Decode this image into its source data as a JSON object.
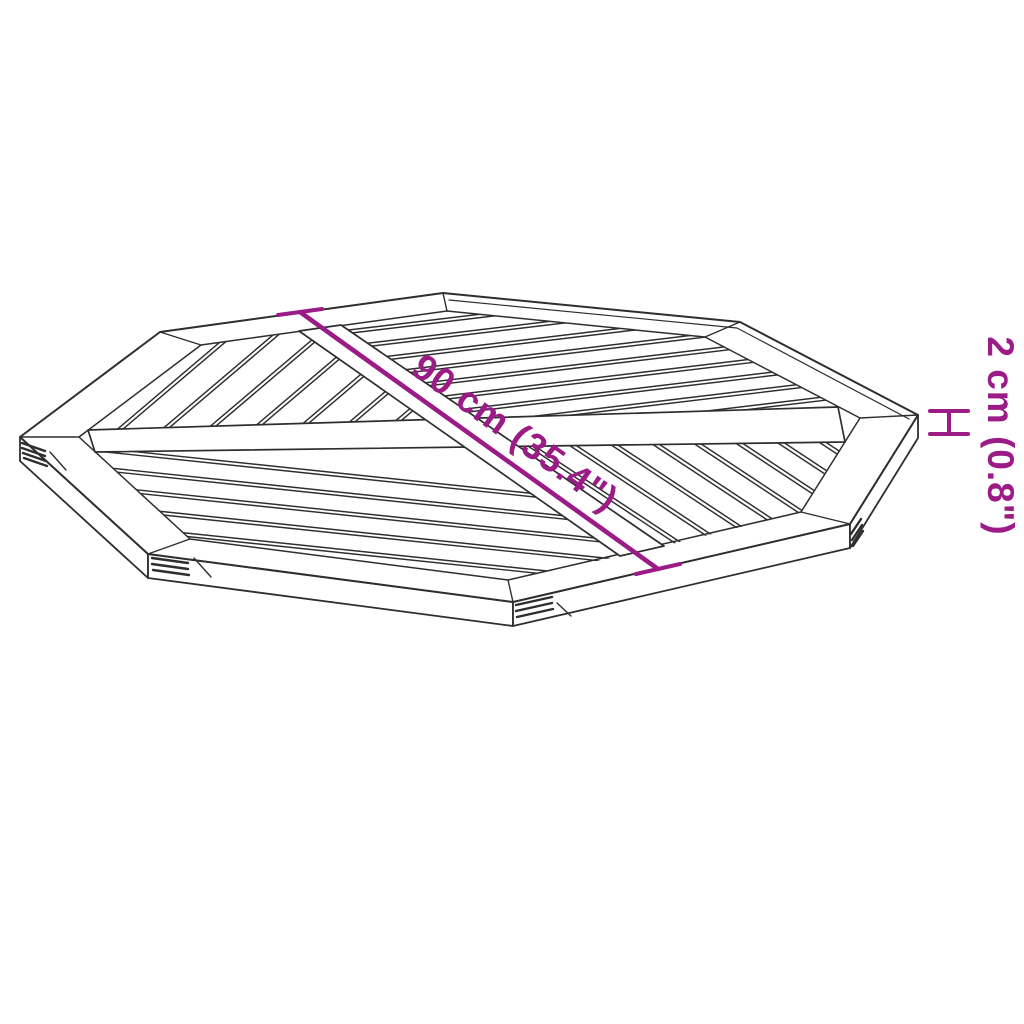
{
  "diagram": {
    "background_color": "#ffffff",
    "line_color": "#2e2e2e",
    "accent_color": "#9b1b87",
    "diagonal_dimension": {
      "label": "90 cm (35.4\")"
    },
    "thickness_dimension": {
      "label": "2 cm (0.8\")"
    }
  }
}
